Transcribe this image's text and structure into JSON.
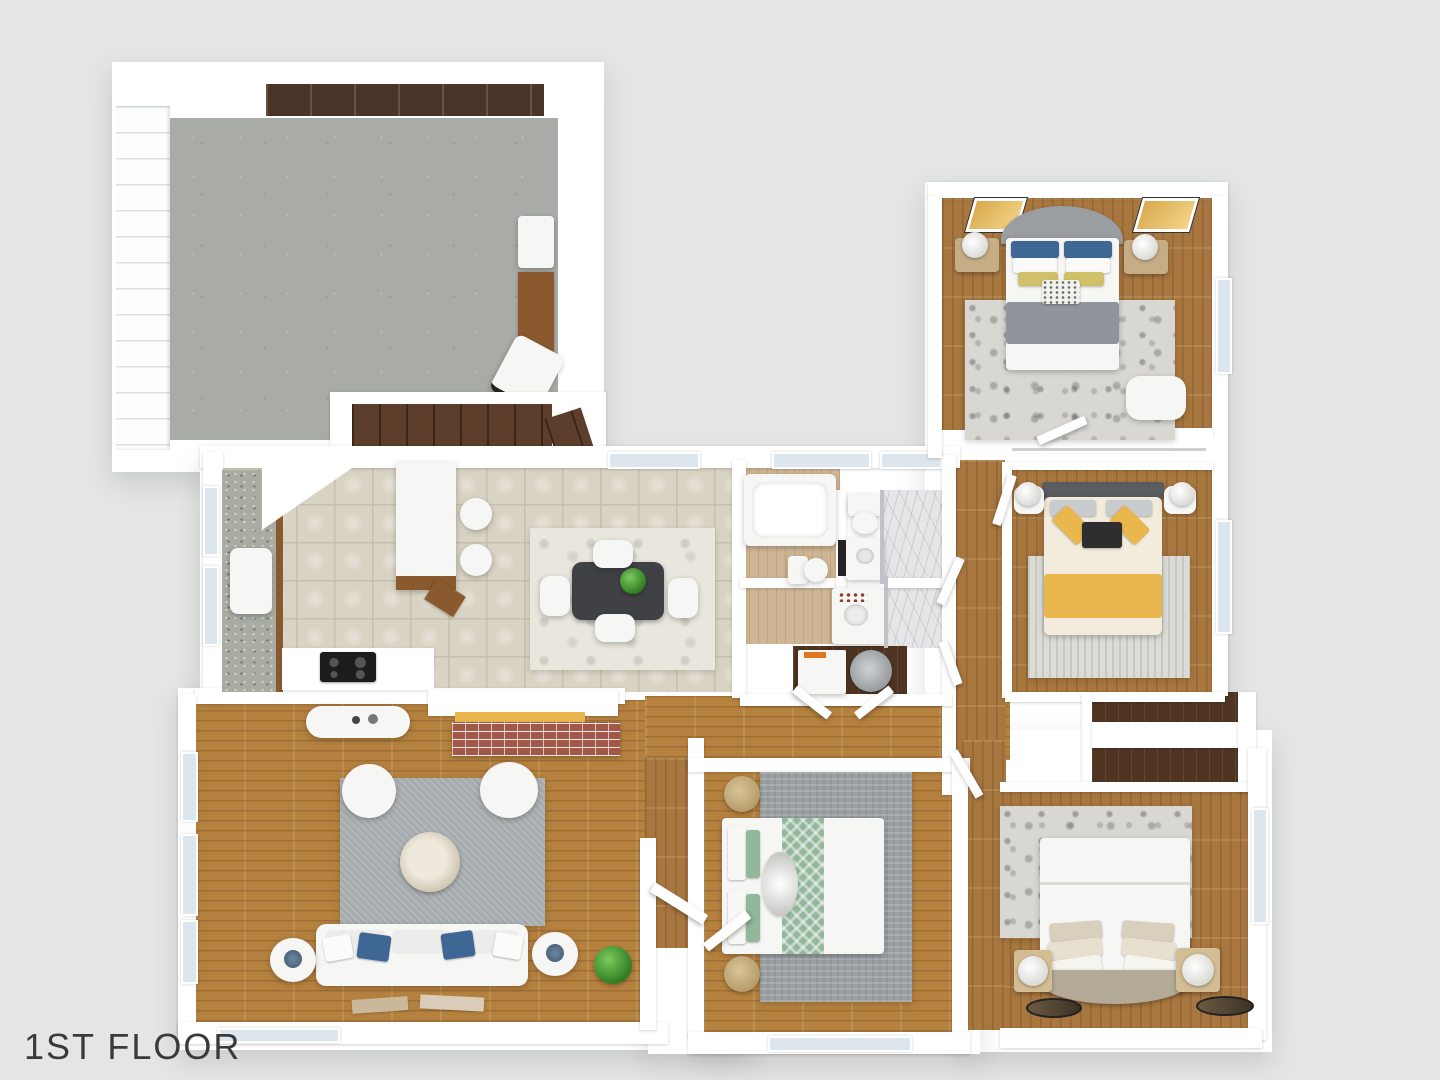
{
  "title": {
    "label": "1ST FLOOR"
  },
  "palette": {
    "background": "#e4e6e5",
    "wall": "#ffffff",
    "concrete": "#a9aba6",
    "tile": "#d9d3c3",
    "tileGrout": "#c6bfae",
    "woodMain": "#b5813f",
    "woodBedroom": "#a87740",
    "woodLight": "#cfb795",
    "closetWood": "#4f3422",
    "stairWood": "#5d3e2a",
    "shelfBrown": "#4a3427",
    "cabinetBrown": "#8a5a2e",
    "granite": "#a8aca3",
    "rugGray": "#a6abad",
    "rugLight": "#dcdcd6",
    "rugDistressed": "#d8d7d2",
    "sofaWhite": "#f6f6f4",
    "pillowBlue": "#3e6796",
    "accentYellow": "#e9b74d",
    "accentGreen": "#93b79b",
    "brick": "#a05848",
    "windowGlass": "#dde6ec",
    "labelColor": "#3a3a3a"
  }
}
